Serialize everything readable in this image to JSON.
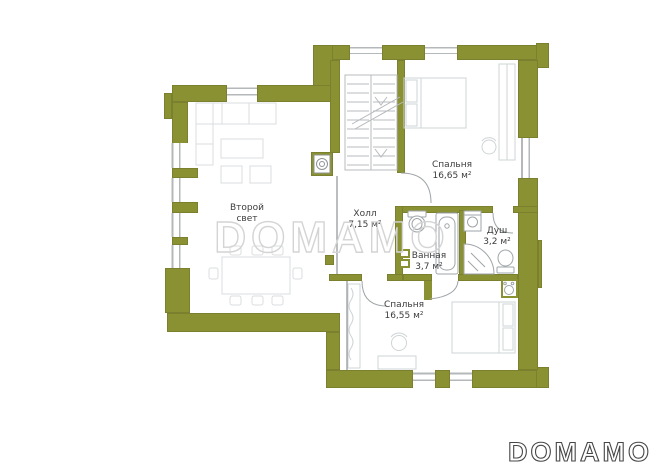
{
  "watermark": "DOMAMO",
  "logo": "DOMAMO",
  "rooms": [
    {
      "name": "Второй свет",
      "area": ""
    },
    {
      "name": "Холл",
      "area": "7,15 м²"
    },
    {
      "name": "Спальня",
      "area": "16,65 м²"
    },
    {
      "name": "Душ",
      "area": "3,2 м²"
    },
    {
      "name": "Ванная",
      "area": "3,7 м²"
    },
    {
      "name": "Спальня",
      "area": "16,55 м²"
    }
  ],
  "colors": {
    "wall": "#8a9132",
    "watermark_stroke": "#d4d4d4",
    "logo_stroke": "#474747",
    "label_text": "#3c3c3c"
  }
}
